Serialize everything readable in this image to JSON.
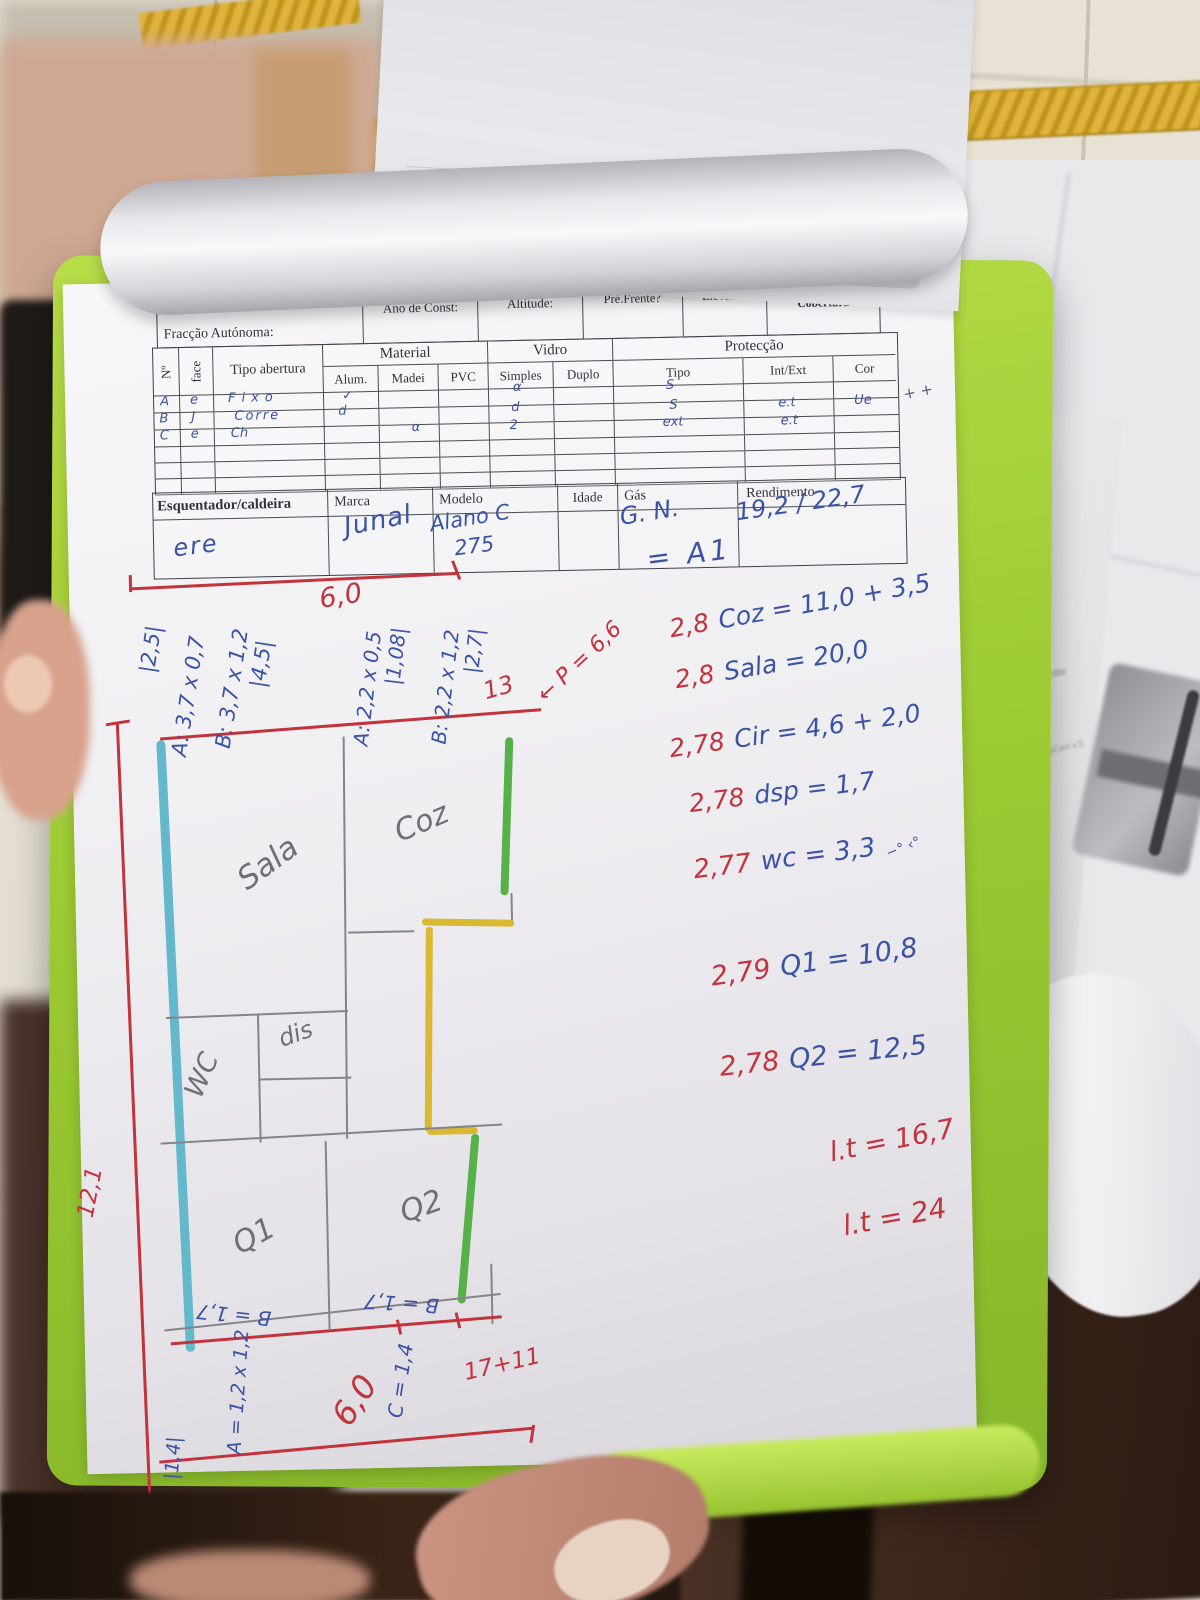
{
  "scene": {
    "side_paper": {
      "line1": "ambos guardar",
      "line2": "MobileDecPropCert v.5"
    }
  },
  "form": {
    "written_title": "Ps. Wh. Orlaye",
    "header": {
      "fraccao": "Fracção Autónoma:",
      "ano": "Ano de Const:",
      "altitude": "Altitude:",
      "pre_frente": "Pré.Frente?",
      "elevador": "Elevador",
      "pavimento": "Pavimento e Cobertura"
    },
    "table": {
      "headers": {
        "no": "Nº",
        "face": "face",
        "tipo_abertura": "Tipo abertura",
        "material": "Material",
        "alum": "Alum.",
        "madei": "Madei",
        "pvc": "PVC",
        "vidro": "Vidro",
        "simples": "Simples",
        "duplo": "Duplo",
        "proteccao": "Protecção",
        "tipo": "Tipo",
        "int_ext": "Int/Ext",
        "cor": "Cor"
      },
      "rows": [
        {
          "no": "A",
          "face": "e",
          "tipo": "Fixo",
          "alum": "✓",
          "madei": "",
          "pvc": "",
          "simples": "α",
          "duplo": "",
          "ptipo": "S",
          "intext": "",
          "cor": ""
        },
        {
          "no": "B",
          "face": "J",
          "tipo": "Corre",
          "alum": "d",
          "madei": "",
          "pvc": "",
          "simples": "d",
          "duplo": "",
          "ptipo": "S",
          "intext": "e.t",
          "cor": "Ue"
        },
        {
          "no": "C",
          "face": "e",
          "tipo": "Ch",
          "alum": "",
          "madei": "",
          "pvc": "α",
          "simples": "2",
          "duplo": "",
          "ptipo": "ext",
          "intext": "e.t",
          "cor": "Ue"
        },
        {
          "no": "",
          "face": "",
          "tipo": "",
          "alum": "",
          "madei": "",
          "pvc": "",
          "simples": "",
          "duplo": "",
          "ptipo": "",
          "intext": "",
          "cor": ""
        },
        {
          "no": "",
          "face": "",
          "tipo": "",
          "alum": "",
          "madei": "",
          "pvc": "",
          "simples": "",
          "duplo": "",
          "ptipo": "",
          "intext": "",
          "cor": ""
        },
        {
          "no": "",
          "face": "",
          "tipo": "",
          "alum": "",
          "madei": "",
          "pvc": "",
          "simples": "",
          "duplo": "",
          "ptipo": "",
          "intext": "",
          "cor": ""
        }
      ],
      "stray_marks": "+ +"
    },
    "heater": {
      "label": "Esquentador/caldeira",
      "marca": "Marca",
      "modelo": "Modelo",
      "idade": "Idade",
      "gas": "Gás",
      "rendimento": "Rendimento",
      "values": {
        "tipo": "ere",
        "marca": "Junal",
        "modelo_1": "Alano C",
        "modelo_2": "275",
        "gas": "G. N.",
        "rendimento": "19,2 / 22,7"
      }
    }
  },
  "calc": {
    "area_ref": "= A1",
    "lines": [
      {
        "coef": "2,8",
        "eq": "Coz = 11,0 + 3,5"
      },
      {
        "coef": "2,8",
        "eq": "Sala = 20,0"
      },
      {
        "coef": "2,78",
        "eq": "Cir = 4,6 + 2,0"
      },
      {
        "coef": "2,78",
        "eq": "dsp = 1,7"
      },
      {
        "coef": "2,77",
        "eq": "wc = 3,3",
        "marks": "−° ‹°"
      },
      {
        "coef": "2,79",
        "eq": "Q1 = 10,8"
      },
      {
        "coef": "2,78",
        "eq": "Q2 = 12,5"
      }
    ],
    "totals": [
      "l.t = 16,7",
      "l.t = 24"
    ]
  },
  "plan": {
    "rooms": {
      "sala": "Sala",
      "coz": "Coz",
      "wc": "WC",
      "dis": "dis",
      "q1": "Q1",
      "q2": "Q2"
    },
    "top_dims": [
      "|2,5|",
      "A: 3,7 x 0,7",
      "B: 3,7 x 1,2",
      "|4,5|",
      "A: 2,2 x 0,5",
      "|1,08|",
      "B: 2,2 x 1,2",
      "|2,7|"
    ],
    "width_top": "6,0",
    "thirteen": "13",
    "perimeter": "← P = 6,6",
    "height_left": "12,1",
    "b_q1": "B = 1,7",
    "b_q2": "B = 1,7",
    "sum_bottom": "17+11",
    "a_bottom": "A = 1,2 x 1,2",
    "a_bottom_val": "|1,4|",
    "width_bottom": "6,0",
    "c_bottom": "C = 1,4"
  }
}
